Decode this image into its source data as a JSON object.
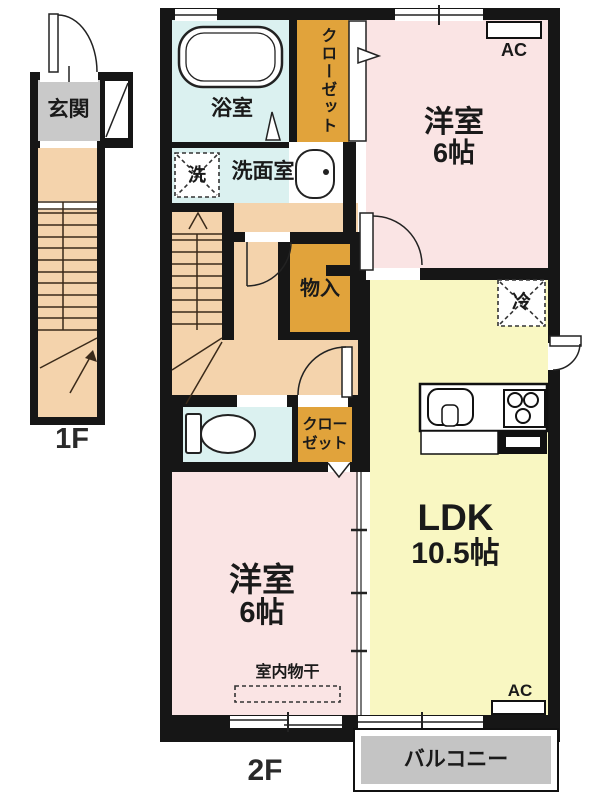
{
  "title": "apartment-floor-plan",
  "floor1": {
    "label": "1F",
    "entrance": "玄関"
  },
  "floor2": {
    "label": "2F",
    "bathroom": "浴室",
    "closet_top": "クローゼット",
    "western_top_name": "洋室",
    "western_top_size": "6帖",
    "washer": "洗",
    "washroom": "洗面室",
    "storage": "物入",
    "fridge": "冷",
    "ldk_name": "LDK",
    "ldk_size": "10.5帖",
    "closet_bottom_line1": "クロー",
    "closet_bottom_line2": "ゼット",
    "western_bottom_name": "洋室",
    "western_bottom_size": "6帖",
    "drying": "室内物干",
    "balcony": "バルコニー",
    "ac": "AC"
  },
  "colors": {
    "pink": "#FAE4E4",
    "yellow": "#F9F7C2",
    "peach": "#F4D3AC",
    "cyan": "#DBF1F0",
    "orange": "#E1A33B",
    "gray": "#C9C9C9",
    "balcony-gray": "#C4C4C4",
    "wall": "#161616",
    "line": "#222222"
  }
}
